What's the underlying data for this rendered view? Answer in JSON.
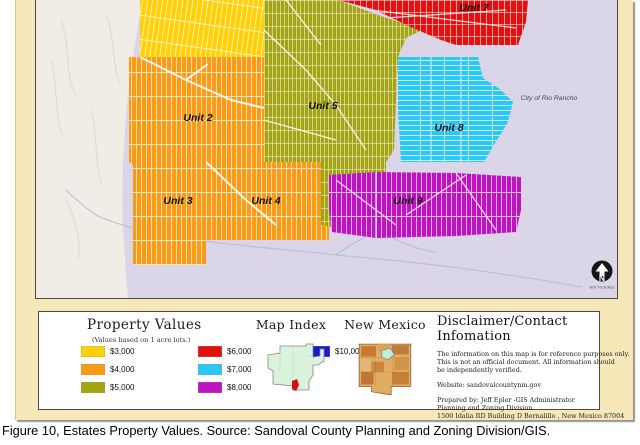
{
  "page": {
    "caption": "Figure 10, Estates Property Values.  Source:  Sandoval County Planning and Zoning Division/GIS."
  },
  "map": {
    "units": [
      {
        "label": "Unit 2"
      },
      {
        "label": "Unit 3"
      },
      {
        "label": "Unit 4"
      },
      {
        "label": "Unit 5"
      },
      {
        "label": "Unit 7"
      },
      {
        "label": "Unit 8"
      },
      {
        "label": "Unit 9"
      }
    ],
    "city_label": "City of Rio Rancho",
    "north_arrow_letter": "N",
    "north_arrow_note": "NOT TO SCALE"
  },
  "legend": {
    "title": "Property Values",
    "subtitle": "(Values based on 1 acre lots.)",
    "items": [
      {
        "label": "$3,000",
        "color": "#FFD006"
      },
      {
        "label": "$4,000",
        "color": "#F99B17"
      },
      {
        "label": "$5,000",
        "color": "#A2A413"
      },
      {
        "label": "$6,000",
        "color": "#E31010"
      },
      {
        "label": "$7,000",
        "color": "#2CC7F2"
      },
      {
        "label": "$8,000",
        "color": "#BE13C0"
      },
      {
        "label": "$10,000",
        "color": "#1A1ACF"
      }
    ]
  },
  "map_index": {
    "title": "Map Index"
  },
  "new_mexico": {
    "title": "New Mexico"
  },
  "disclaimer": {
    "title": "Disclaimer/Contact Infomation",
    "line1": "The information on this map is for reference purposes only.",
    "line2": "This is not an official document. All  information should",
    "line3": "be independently verified.",
    "website_line": "Website:  sandovalcountynm.gov",
    "prepared1": "Prepared by: Jeff Epler -GIS Administrator",
    "prepared2": "Planning and Zoning Division",
    "prepared3": "1500 Idalia RD Building D Bernalillo , New Mexico 87004"
  },
  "colors": {
    "lavender": "#DBD5E8",
    "terrain": "#F0ECE6",
    "river": "#A8B4DA",
    "frame_tan": "#F7E8BA"
  }
}
